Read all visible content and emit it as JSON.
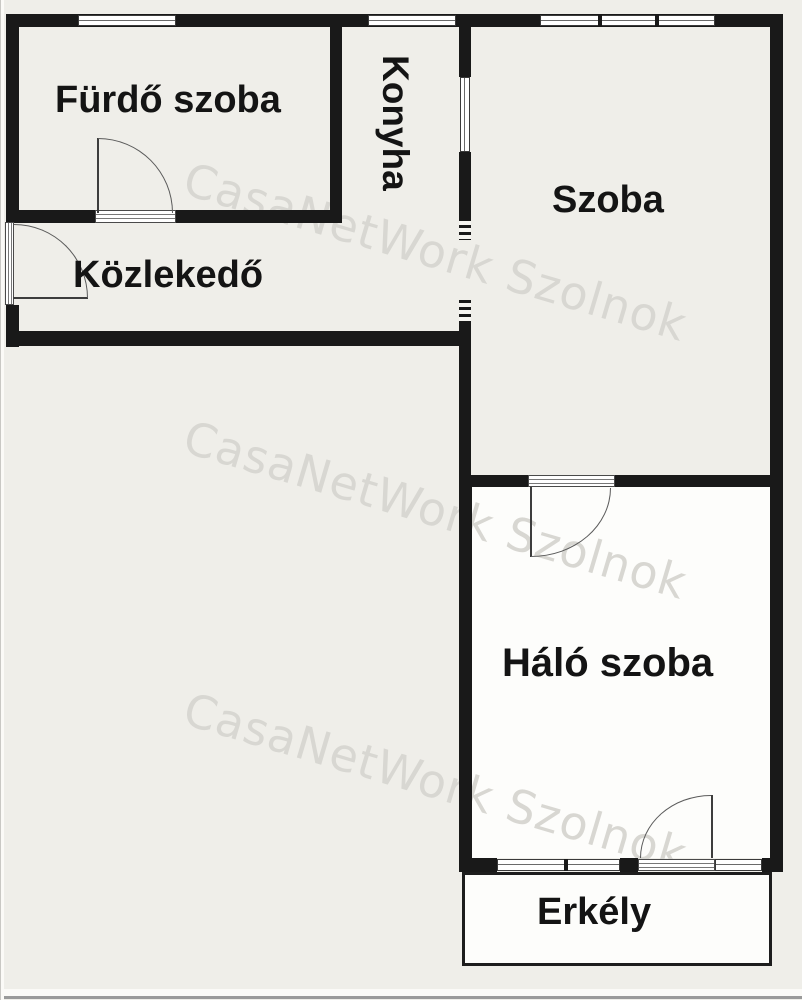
{
  "floorplan": {
    "rooms": [
      {
        "name": "furdo-szoba",
        "label": "Fürdő szoba"
      },
      {
        "name": "konyha",
        "label": "Konyha"
      },
      {
        "name": "szoba",
        "label": "Szoba"
      },
      {
        "name": "kozlekedo",
        "label": "Közlekedő"
      },
      {
        "name": "halo-szoba",
        "label": "Háló szoba"
      },
      {
        "name": "erkely",
        "label": "Erkély"
      }
    ],
    "watermark": {
      "text": "CasaNetWork Szolnok",
      "color": "#d8d7d2",
      "repeats": 3
    },
    "colors": {
      "background": "#efeee9",
      "wall": "#191919",
      "white_room_fill": "#fdfdfb",
      "thin_line": "#555555",
      "label_text": "#141414"
    }
  }
}
